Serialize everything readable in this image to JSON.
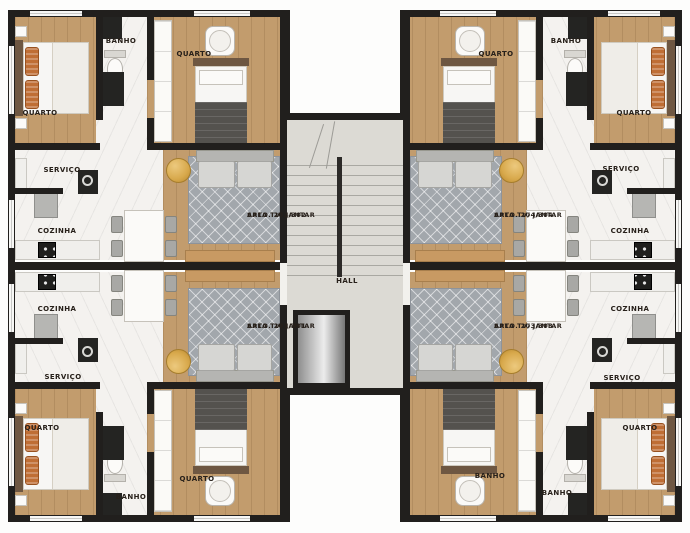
{
  "plan_title": "floor-plan",
  "colors": {
    "wall": "#211f1d",
    "wood_floor": "#c29c6d",
    "marble_floor": "#f4f2ef",
    "hall_floor": "#dcdad4",
    "rug": "#a2a7ac",
    "gold_table": "#d8a94c",
    "label_text": "#27201a"
  },
  "rooms": {
    "tl_quarto_main": "QUARTO",
    "tl_banho": "BANHO",
    "tl_quarto_2": "QUARTO",
    "tl_servico": "SERVIÇO",
    "tl_cozinha": "COZINHA",
    "tr_quarto_2": "QUARTO",
    "tr_banho": "BANHO",
    "tr_quarto_main": "QUARTO",
    "tr_servico": "SERVIÇO",
    "tr_cozinha": "COZINHA",
    "bl_cozinha": "COZINHA",
    "bl_servico": "SERVIÇO",
    "bl_quarto_main": "QUARTO",
    "bl_banho": "BANHO",
    "bl_quarto_2": "QUARTO",
    "br_cozinha": "COZINHA",
    "br_servico": "SERVIÇO",
    "br_banho_upper": "BANHO",
    "br_banho": "BANHO",
    "br_quarto_main": "QUARTO",
    "hall": "HALL"
  },
  "units": {
    "apt_202_302": {
      "living": "SALA TV/ JANTAR",
      "apto": "APTO. 202/302"
    },
    "apt_204_304": {
      "living": "SALA TV/ JANTAR",
      "apto": "APTO. 204/304"
    },
    "apt_201_301": {
      "living": "SALA TV/ JANTAR",
      "apto": "APTO. 201/301"
    },
    "apt_203_303": {
      "living": "SALA TV/ JANTAR",
      "apto": "APTO. 203/303"
    }
  }
}
